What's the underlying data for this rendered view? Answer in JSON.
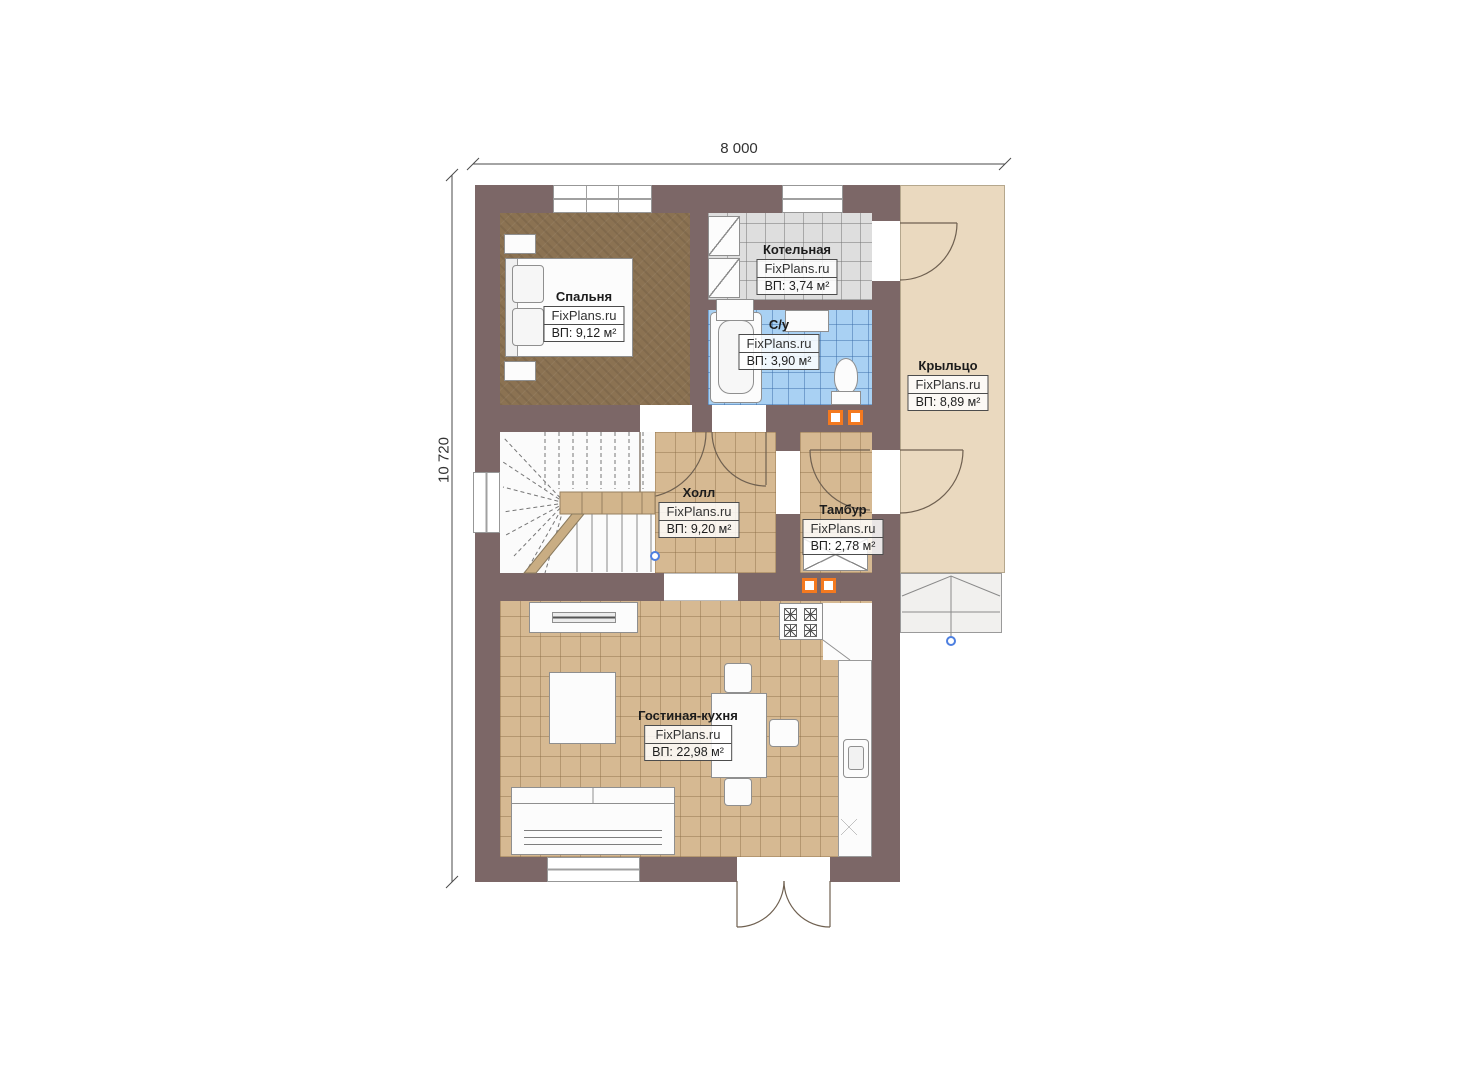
{
  "dimensions": {
    "width": "8 000",
    "height": "10 720"
  },
  "brand": "FixPlans.ru",
  "rooms": [
    {
      "key": "bedroom",
      "name": "Спальня",
      "area": "ВП: 9,12 м²"
    },
    {
      "key": "boiler",
      "name": "Котельная",
      "area": "ВП: 3,74 м²"
    },
    {
      "key": "bathroom",
      "name": "С/у",
      "area": "ВП: 3,90 м²"
    },
    {
      "key": "hall",
      "name": "Холл",
      "area": "ВП: 9,20 м²"
    },
    {
      "key": "tambour",
      "name": "Тамбур",
      "area": "ВП: 2,78 м²"
    },
    {
      "key": "living",
      "name": "Гостиная-кухня",
      "area": "ВП: 22,98 м²"
    },
    {
      "key": "porch",
      "name": "Крыльцо",
      "area": "ВП: 8,89 м²"
    }
  ],
  "icons": {
    "vent_marker": "orange-square-vent",
    "survey_point": "blue-circle-marker"
  },
  "colors": {
    "wall": "#7c6767",
    "bedroom_floor": "#8b7252",
    "tile_tan": "#d6b992",
    "tile_gray": "#dedede",
    "tile_blue": "#a9d1f3",
    "porch": "#ead9bf",
    "accent_orange": "#f4791f",
    "marker_blue": "#4d7fe0"
  }
}
